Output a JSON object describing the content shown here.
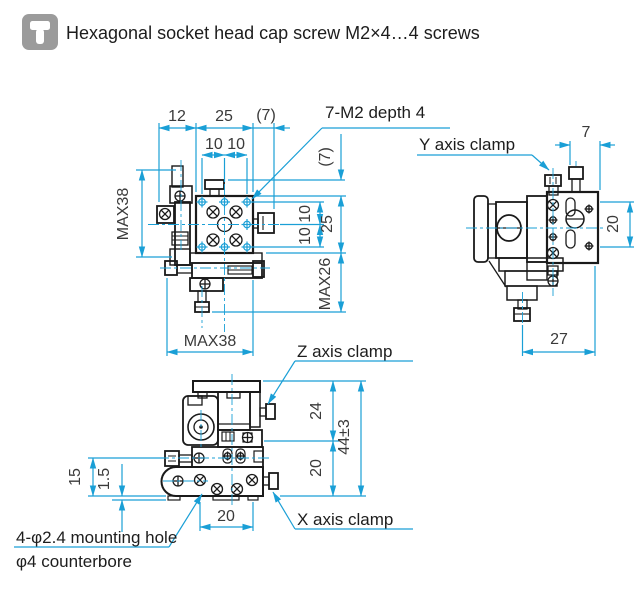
{
  "header": {
    "title": "Hexagonal socket head cap screw M2×4…4 screws",
    "icon": "cap-screw-icon"
  },
  "colors": {
    "dimension_line": "#1a9fd6",
    "drawing_line": "#1a1a1a",
    "dimension_text": "#3a3a3a",
    "icon_background": "#9b9b9b"
  },
  "front_view": {
    "dim_left_offset": "12",
    "dim_width": "25",
    "dim_side_offset": "(7)",
    "dim_hole_pitch_h": "10 10",
    "dim_height_max_left": "MAX38",
    "dim_top_offset": "(7)",
    "dim_hole_pitch_v": "10 10",
    "dim_height": "25",
    "dim_lower_max": "MAX26",
    "dim_width_max": "MAX38",
    "label_tapped_holes": "7-M2 depth 4"
  },
  "side_view": {
    "label_y_clamp": "Y axis clamp",
    "dim_knob_offset": "7",
    "dim_height": "20",
    "dim_depth": "27"
  },
  "bottom_view": {
    "label_z_clamp": "Z axis clamp",
    "label_x_clamp": "X axis clamp",
    "label_mounting_hole": "4-φ2.4 mounting hole",
    "label_counterbore": "φ4 counterbore",
    "dim_upper": "24",
    "dim_total_height": "44±3",
    "dim_lower": "20",
    "dim_base_height": "15",
    "dim_base_step": "1.5",
    "dim_hole_pitch": "20"
  }
}
